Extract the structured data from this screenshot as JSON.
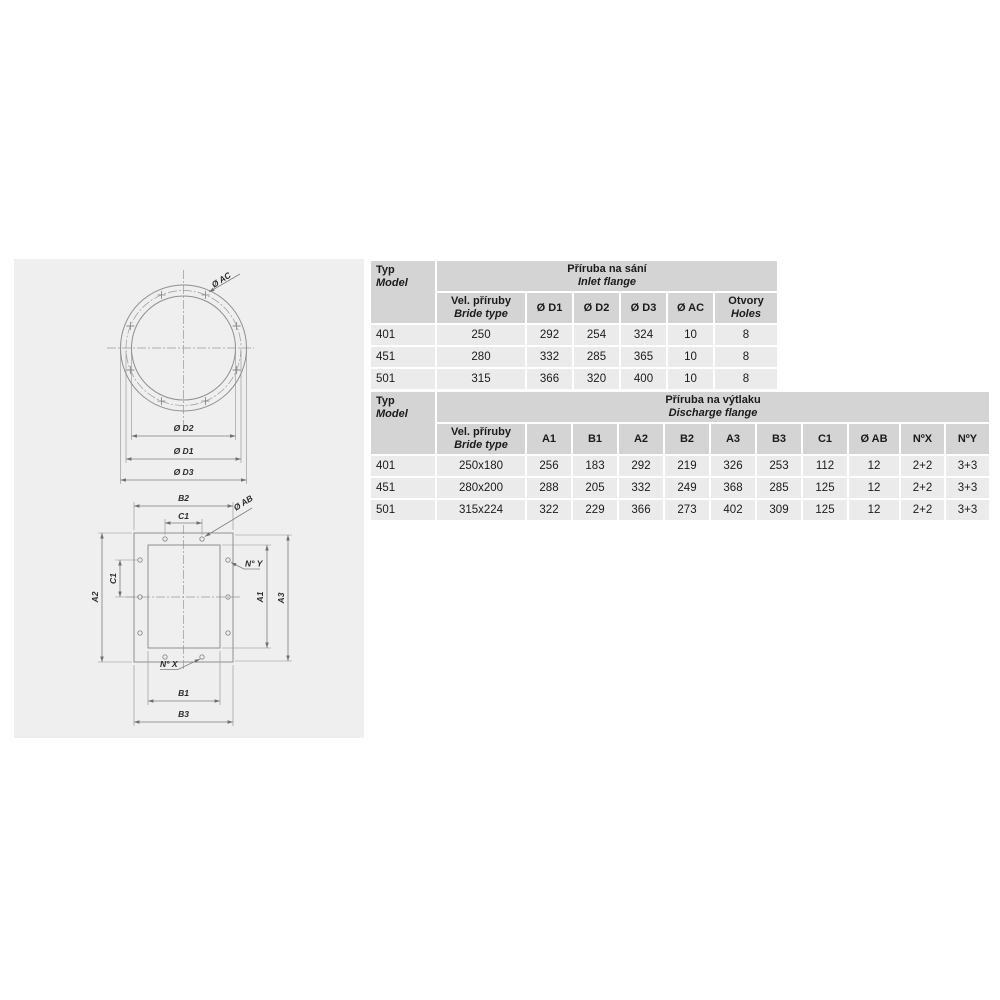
{
  "colors": {
    "panel_bg": "#efefef",
    "table_header_bg": "#d4d4d4",
    "table_cell_bg": "#ebebeb",
    "drawing_line": "#8f8f8f",
    "text": "#1b1b1b"
  },
  "diagram": {
    "inlet_labels": {
      "ac": "Ø AC",
      "d2": "Ø D2",
      "d1": "Ø D1",
      "d3": "Ø D3"
    },
    "discharge_labels": {
      "b2": "B2",
      "c1_top": "C1",
      "ab": "Ø AB",
      "n_y": "N° Y",
      "a2": "A2",
      "c1_left": "C1",
      "a1": "A1",
      "a3": "A3",
      "n_x": "N° X",
      "b1": "B1",
      "b3": "B3"
    }
  },
  "inlet_table": {
    "corner": {
      "l1": "Typ",
      "l2": "Model"
    },
    "title": {
      "l1": "Příruba na sání",
      "l2": "Inlet flange"
    },
    "col_bride": {
      "l1": "Vel. příruby",
      "l2": "Bride type"
    },
    "cols": [
      "Ø D1",
      "Ø D2",
      "Ø D3",
      "Ø AC"
    ],
    "col_holes": {
      "l1": "Otvory",
      "l2": "Holes"
    },
    "rows": [
      [
        "401",
        "250",
        "292",
        "254",
        "324",
        "10",
        "8"
      ],
      [
        "451",
        "280",
        "332",
        "285",
        "365",
        "10",
        "8"
      ],
      [
        "501",
        "315",
        "366",
        "320",
        "400",
        "10",
        "8"
      ]
    ]
  },
  "discharge_table": {
    "corner": {
      "l1": "Typ",
      "l2": "Model"
    },
    "title": {
      "l1": "Příruba na výtlaku",
      "l2": "Discharge flange"
    },
    "col_bride": {
      "l1": "Vel. příruby",
      "l2": "Bride type"
    },
    "cols": [
      "A1",
      "B1",
      "A2",
      "B2",
      "A3",
      "B3",
      "C1",
      "Ø AB",
      "NºX",
      "NºY"
    ],
    "rows": [
      [
        "401",
        "250x180",
        "256",
        "183",
        "292",
        "219",
        "326",
        "253",
        "112",
        "12",
        "2+2",
        "3+3"
      ],
      [
        "451",
        "280x200",
        "288",
        "205",
        "332",
        "249",
        "368",
        "285",
        "125",
        "12",
        "2+2",
        "3+3"
      ],
      [
        "501",
        "315x224",
        "322",
        "229",
        "366",
        "273",
        "402",
        "309",
        "125",
        "12",
        "2+2",
        "3+3"
      ]
    ]
  }
}
